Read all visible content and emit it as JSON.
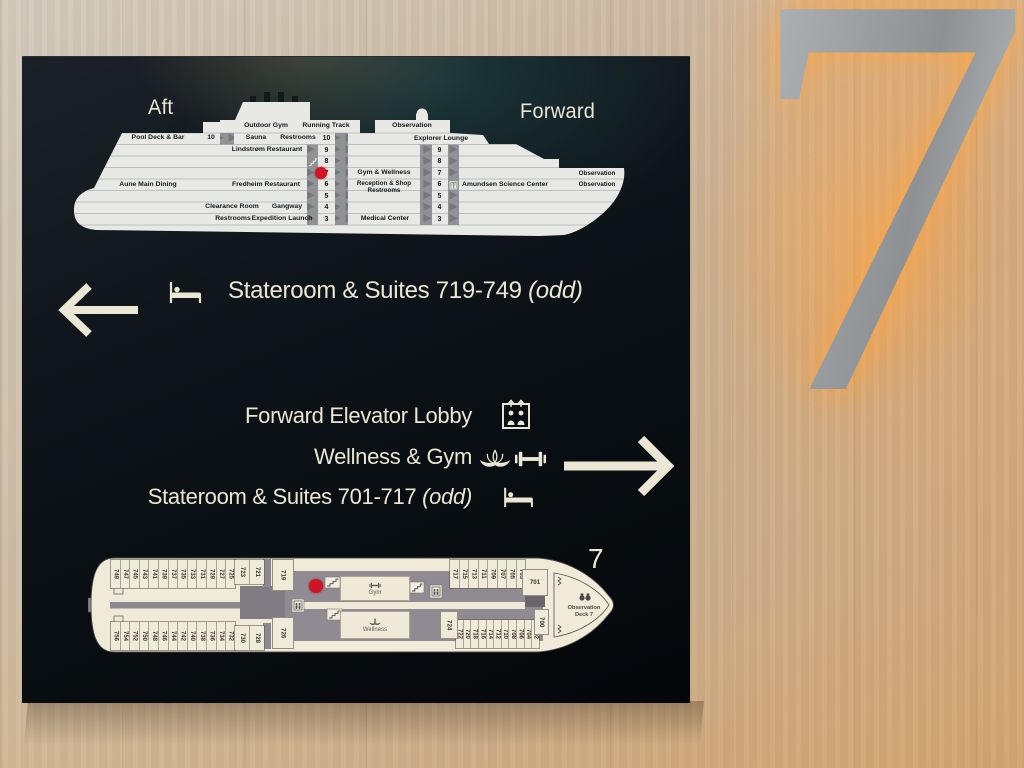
{
  "wall": {
    "deck_numeral": "7"
  },
  "sign": {
    "profile": {
      "aft_title": "Aft",
      "forward_title": "Forward",
      "labels": {
        "outdoor_gym": "Outdoor Gym",
        "running_track": "Running Track",
        "observation_top": "Observation",
        "pool_deck": "Pool Deck & Bar",
        "aft_deck_no": "10",
        "sauna": "Sauna",
        "restrooms_10": "Restrooms",
        "lindstrom": "Lindstrøm Restaurant",
        "explorer_lounge": "Explorer Lounge",
        "gym_wellness": "Gym & Wellness",
        "reception_line1": "Reception & Shop",
        "reception_line2": "Restrooms",
        "aune": "Aune Main Dining",
        "fredheim": "Fredheim Restaurant",
        "amundsen": "Amundsen Science Center",
        "observation_upper": "Observation",
        "observation_lower": "Observation",
        "clearance": "Clearance Room",
        "gangway": "Gangway",
        "restrooms_3": "Restrooms",
        "expedition": "Expedition Launch",
        "medical": "Medical Center"
      },
      "left_deck_numbers": [
        "10",
        "9",
        "8",
        "7",
        "6",
        "5",
        "4",
        "3"
      ],
      "right_deck_numbers": [
        "9",
        "8",
        "7",
        "6",
        "5",
        "4",
        "3"
      ]
    },
    "wayfinding": {
      "row_left": {
        "label": "Stateroom & Suites 719-749",
        "suffix": "(odd)"
      },
      "forward_lobby": "Forward Elevator Lobby",
      "wellness_gym": "Wellness & Gym",
      "stateroom_fwd": {
        "label": "Stateroom & Suites 701-717",
        "suffix": "(odd)"
      }
    },
    "deck_plan": {
      "deck_label": "7",
      "aft_cabins_top": [
        "749",
        "747",
        "745",
        "743",
        "741",
        "739",
        "737",
        "735",
        "733",
        "731",
        "729",
        "727",
        "725"
      ],
      "aft_suites_top": [
        "723",
        "721"
      ],
      "cabin_719": "719",
      "aft_cabins_bottom": [
        "756",
        "754",
        "752",
        "750",
        "748",
        "746",
        "744",
        "742",
        "740",
        "738",
        "736",
        "734",
        "732"
      ],
      "aft_suites_bottom": [
        "730",
        "728"
      ],
      "cabin_726": "726",
      "gym": "Gym",
      "wellness": "Wellness",
      "cabin_724": "724",
      "bow_cabins_top": [
        "717",
        "715",
        "713",
        "711",
        "709",
        "707",
        "705",
        "703"
      ],
      "cabin_701": "701",
      "bow_cabins_bottom": [
        "722",
        "720",
        "718",
        "716",
        "714",
        "712",
        "710",
        "708",
        "706",
        "704",
        "702"
      ],
      "cabin_700": "700",
      "observation_line1": "Observation",
      "observation_line2": "Deck 7"
    }
  },
  "colors": {
    "board_bg": "#0c1116",
    "text_cream": "#ece6d4",
    "hull_white": "#e8e9e5",
    "plan_cream": "#f0ead9",
    "corridor_gray": "#8d8890",
    "marker_red": "#d11326",
    "glow_orange": "#f5a545",
    "wood": "#c9b094"
  }
}
